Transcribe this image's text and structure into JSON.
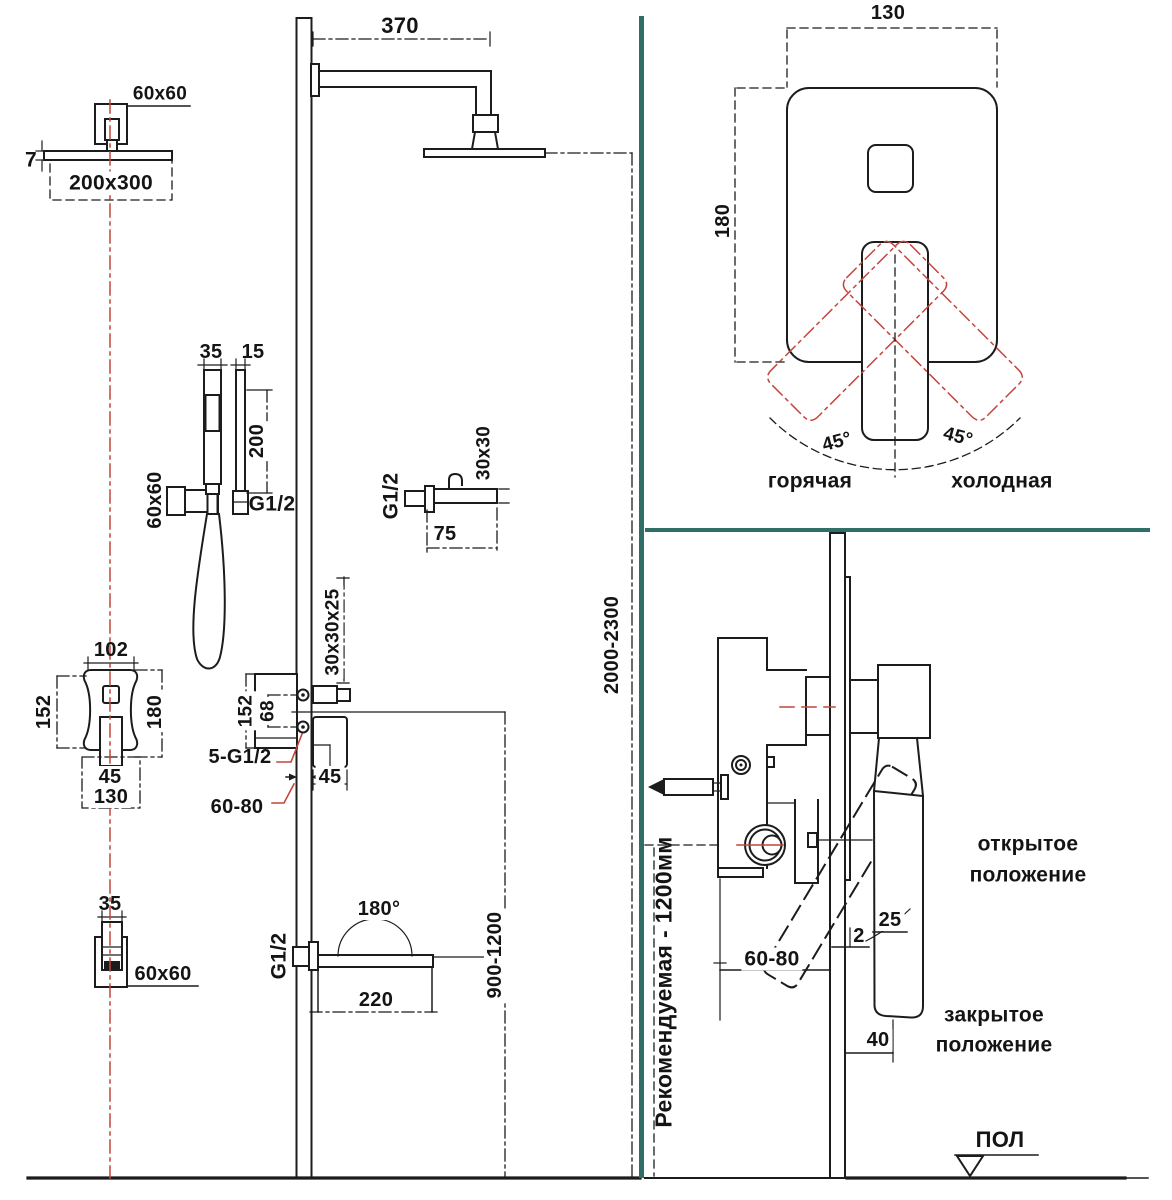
{
  "colors": {
    "line": "#1c1c1c",
    "accent_red": "#c4453c",
    "teal_divider": "#2e6f68",
    "background": "#ffffff"
  },
  "overhead_shower": {
    "mount_size": "60x60",
    "head_thickness": "7",
    "head_size": "200x300",
    "arm_length": "370"
  },
  "hand_shower": {
    "handle_width": "35",
    "bar_width": "15",
    "bar_length": "200",
    "hose_thread": "G1/2",
    "holder_size": "60x60"
  },
  "outlet_elbow": {
    "thread": "G1/2",
    "length": "75",
    "section": "30x30"
  },
  "mixer_front": {
    "top_width": "102",
    "left_height": "152",
    "right_height": "180",
    "spout_width": "45",
    "bottom_width": "130"
  },
  "mixer_side": {
    "section": "30x30x25",
    "height": "152",
    "ports_gap": "68",
    "connections": "5-G1/2",
    "depth": "45",
    "embed_depth": "60-80"
  },
  "spout": {
    "thread": "G1/2",
    "swivel_angle": "180°",
    "length": "220",
    "height_range": "900-1200"
  },
  "parked_hand_shower": {
    "width": "35",
    "holder_size": "60x60"
  },
  "overall_height": "2000-2300",
  "trim_panel": {
    "width": "130",
    "height": "180",
    "angle_left": "45°",
    "angle_right": "45°",
    "hot_label": "горячая",
    "cold_label": "холодная"
  },
  "installation": {
    "recommended_height": "Рекомендуемая - 1200мм",
    "embed_depth": "60-80",
    "plate_gap": "2",
    "handle_angle": "25",
    "handle_offset": "40",
    "open_position_line1": "открытое",
    "open_position_line2": "положение",
    "closed_position_line1": "закрытое",
    "closed_position_line2": "положение",
    "floor_label": "ПОЛ"
  }
}
